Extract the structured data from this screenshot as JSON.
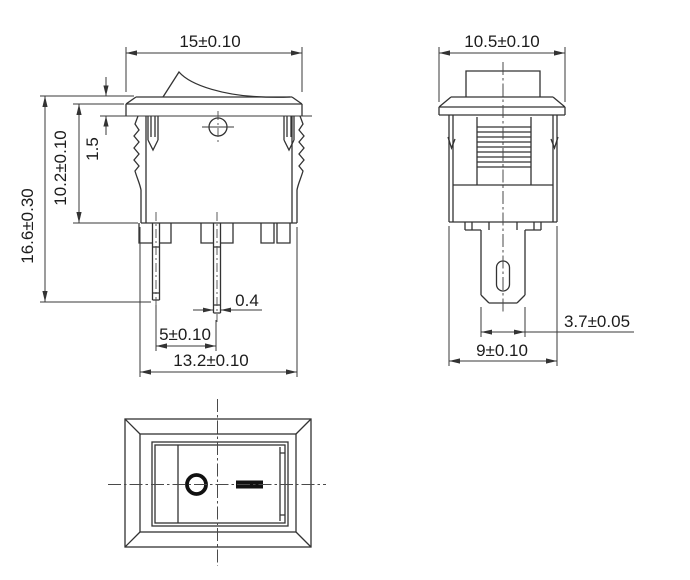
{
  "drawing": {
    "type": "technical-drawing",
    "subject": "miniature rocker switch, three-view dimensioned drawing",
    "units": "mm",
    "colors": {
      "line": "#333333",
      "text": "#1c1c1c",
      "symbol": "#111111",
      "background": "#ffffff"
    },
    "front_view": {
      "name": "front view",
      "dimensions": {
        "overall_width": "15±0.10",
        "flange_thickness": "1.5",
        "body_height": "10.2±0.10",
        "overall_height": "16.6±0.30",
        "terminal_thickness": "0.4",
        "terminal_pitch": "5±0.10",
        "body_width": "13.2±0.10"
      }
    },
    "side_view": {
      "name": "side view",
      "dimensions": {
        "overall_depth": "10.5±0.10",
        "terminal_tab_width": "3.7±0.05",
        "body_depth": "9±0.10"
      }
    },
    "top_view": {
      "name": "top panel view",
      "symbols": {
        "off": "O",
        "on": "—"
      }
    }
  }
}
